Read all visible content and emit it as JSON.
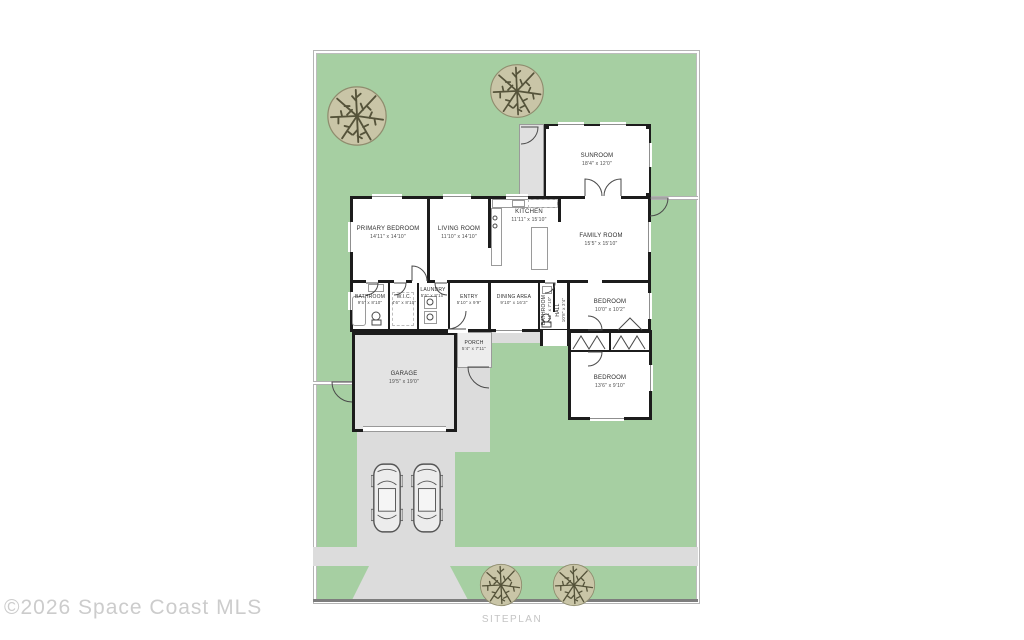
{
  "watermark": "©2026 Space Coast MLS",
  "caption": "SITEPLAN",
  "colors": {
    "lot_green": "#a6cfa2",
    "pavement_gray": "#dcdcdc",
    "garage_fill": "#e3e3e3",
    "wall_black": "#1c1c1c",
    "tree_fill": "#c9c5a7",
    "watermark_gray": "#cccccc"
  },
  "icons": {
    "tree": "tree-top-view-icon",
    "car": "car-top-view-icon"
  },
  "rooms": [
    {
      "name": "SUNROOM",
      "dims": "18'4\" x 12'0\""
    },
    {
      "name": "KITCHEN",
      "dims": "11'11\" x 15'10\""
    },
    {
      "name": "FAMILY ROOM",
      "dims": "15'5\" x 15'10\""
    },
    {
      "name": "PRIMARY BEDROOM",
      "dims": "14'11\" x 14'10\""
    },
    {
      "name": "LIVING ROOM",
      "dims": "11'10\" x 14'10\""
    },
    {
      "name": "BATHROOM",
      "dims": "9'5\" x 8'10\""
    },
    {
      "name": "W.I.C.",
      "dims": "4'6\" x 8'10\""
    },
    {
      "name": "LAUNDRY",
      "dims": "5'5\" x 8'10\""
    },
    {
      "name": "ENTRY",
      "dims": "5'10\" x 9'9\""
    },
    {
      "name": "DINING AREA",
      "dims": "9'10\" x 16'3\""
    },
    {
      "name": "BATHROOM",
      "dims": "4'11\" x 7'10\""
    },
    {
      "name": "HALL",
      "dims": "10'8\" x 3'4\""
    },
    {
      "name": "BEDROOM",
      "dims": "10'0\" x 10'2\""
    },
    {
      "name": "BEDROOM",
      "dims": "13'6\" x 9'10\""
    },
    {
      "name": "GARAGE",
      "dims": "19'5\" x 19'0\""
    },
    {
      "name": "PORCH",
      "dims": "5'4\" x 7'11\""
    }
  ]
}
